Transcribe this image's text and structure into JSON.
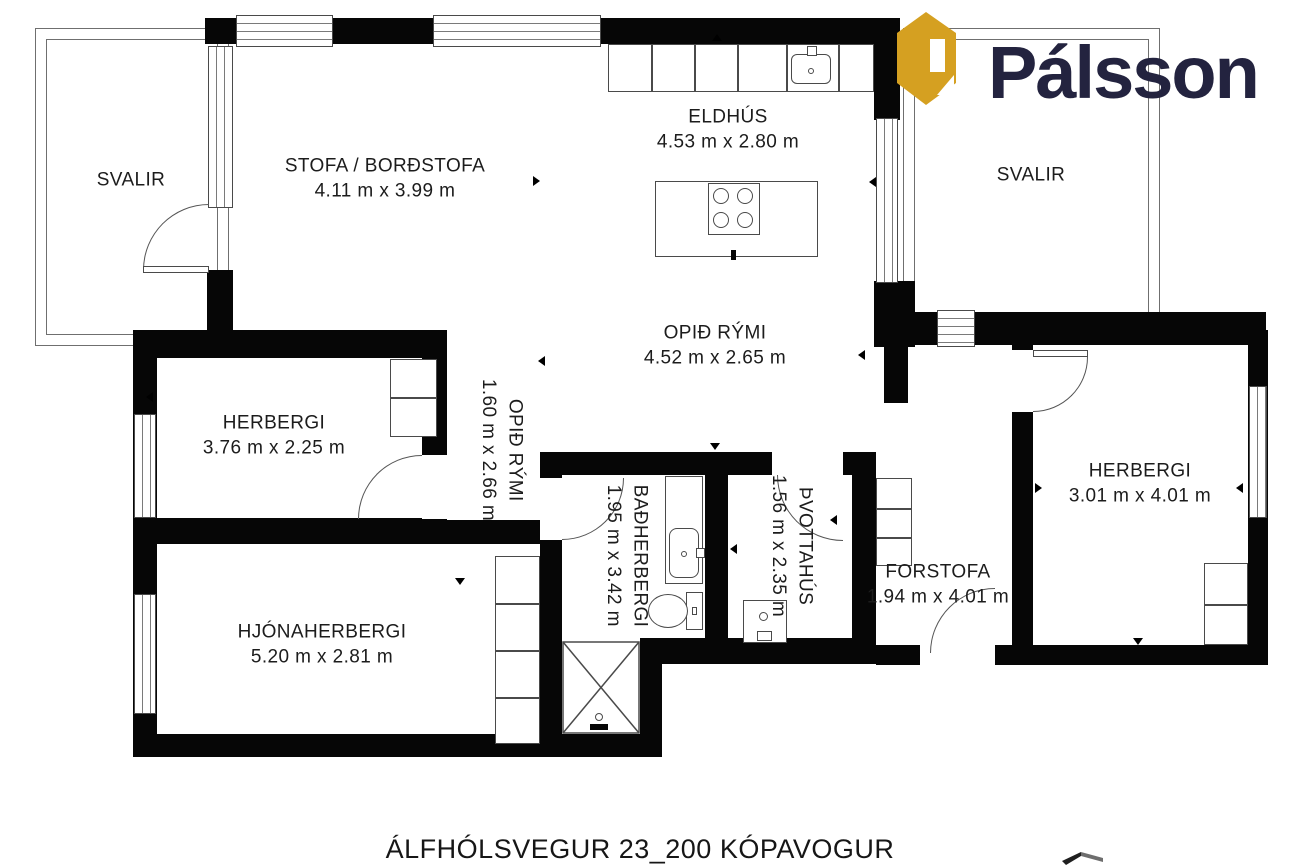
{
  "brand": {
    "name": "Pálsson",
    "logo_icon": "house-p-monogram",
    "logo_gold": "#d5a021",
    "text_color": "#23233f"
  },
  "footer": {
    "address": "ÁLFHÓLSVEGUR 23_200 KÓPAVOGUR"
  },
  "rooms": {
    "svalir_left": {
      "name": "SVALIR",
      "dims": ""
    },
    "stofa": {
      "name": "STOFA / BORÐSTOFA",
      "dims": "4.11 m x 3.99 m"
    },
    "eldhus": {
      "name": "ELDHÚS",
      "dims": "4.53 m x 2.80 m"
    },
    "svalir_right": {
      "name": "SVALIR",
      "dims": ""
    },
    "opid_rymi": {
      "name": "OPIÐ RÝMI",
      "dims": "4.52 m x 2.65 m"
    },
    "opid_rymi_gangur": {
      "name": "OPIÐ RÝMI",
      "dims": "1.60 m x 2.66 m"
    },
    "herbergi_vinstri": {
      "name": "HERBERGI",
      "dims": "3.76 m x 2.25 m"
    },
    "hjonaherbergi": {
      "name": "HJÓNAHERBERGI",
      "dims": "5.20 m x 2.81 m"
    },
    "badherbergi": {
      "name": "BAÐHERBERGI",
      "dims": "1.95 m x 3.42 m"
    },
    "thvottahus": {
      "name": "ÞVOTTAHÚS",
      "dims": "1.56 m x 2.35 m"
    },
    "forstofa": {
      "name": "FORSTOFA",
      "dims": "1.94 m x 4.01 m"
    },
    "herbergi_haegri": {
      "name": "HERBERGI",
      "dims": "3.01 m x 4.01 m"
    }
  }
}
